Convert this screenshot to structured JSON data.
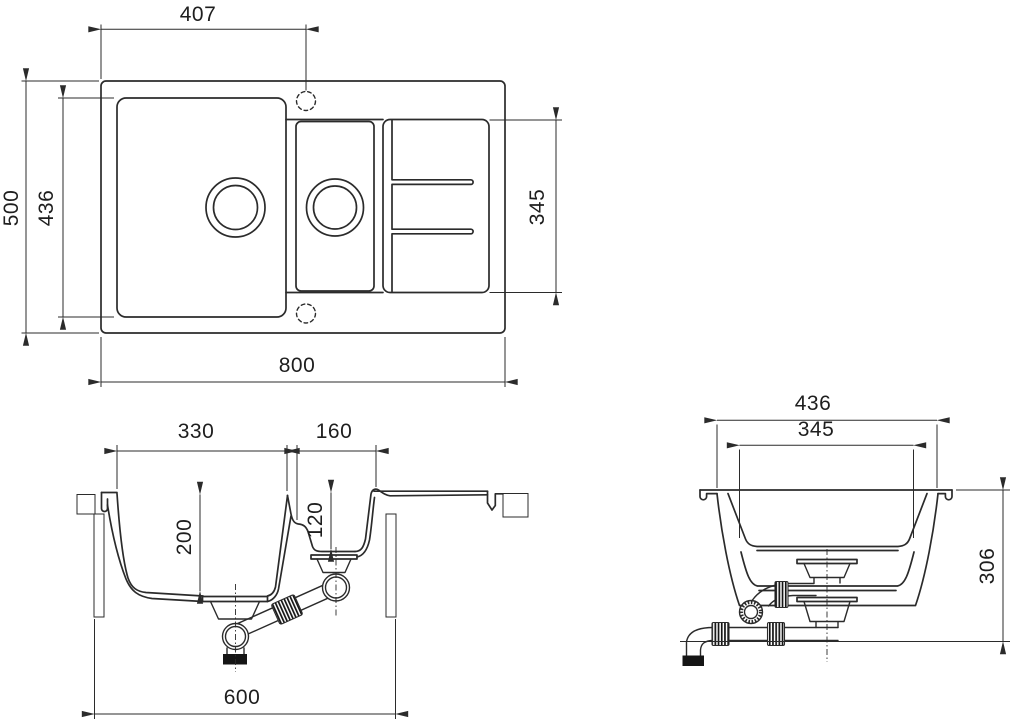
{
  "drawing": {
    "subject": "kitchen sink with one and a half bowls and drainboard",
    "line_color": "#2b2b2b",
    "background_color": "#ffffff"
  },
  "dims": {
    "plan": {
      "faucet_offset": "407",
      "overall_depth": "500",
      "bowl_zone_depth": "436",
      "drainer_depth": "345",
      "overall_width": "800"
    },
    "front": {
      "main_bowl_width": "330",
      "half_bowl_width": "160",
      "main_bowl_depth": "200",
      "half_bowl_depth": "120",
      "cabinet_width": "600"
    },
    "side": {
      "outer_width": "436",
      "inner_width": "345",
      "height_with_trap": "306"
    }
  }
}
